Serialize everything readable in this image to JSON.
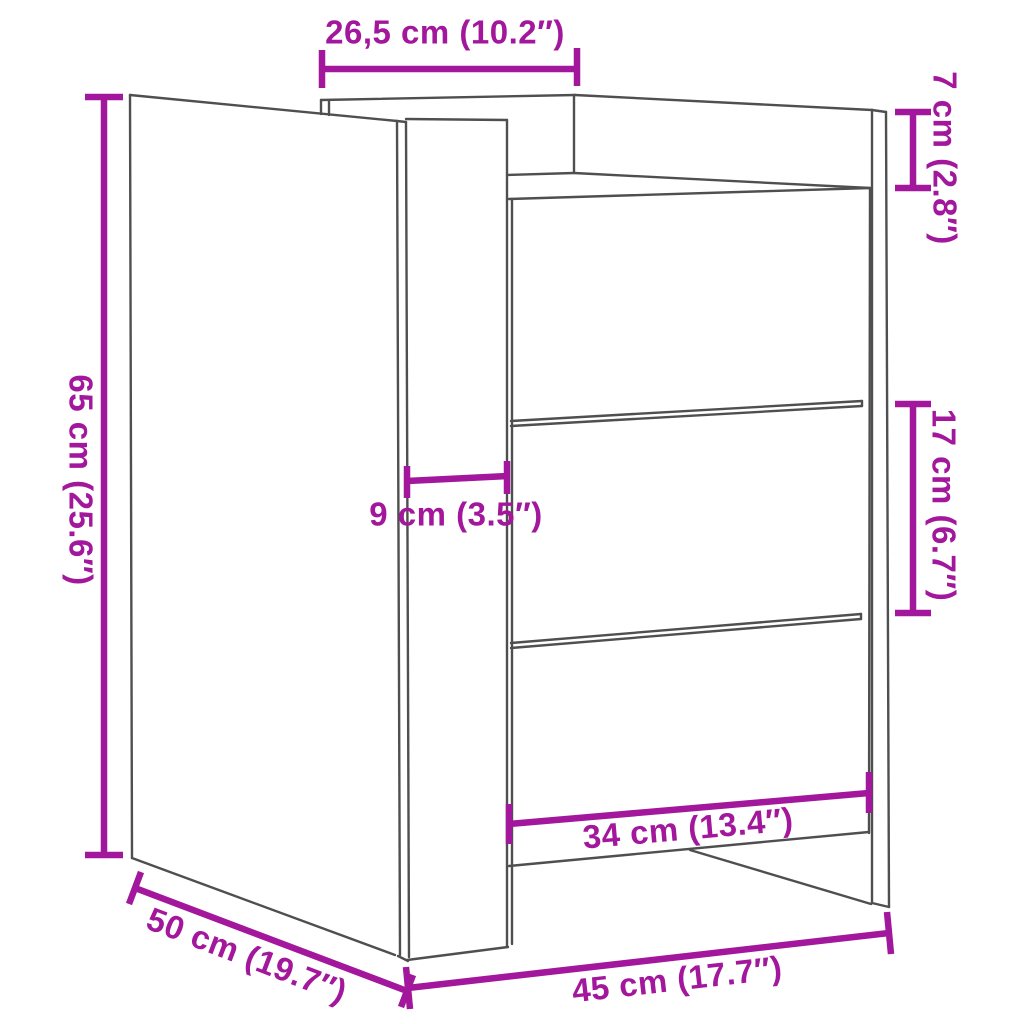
{
  "diagram": {
    "subject": "three-drawer-bedside-cabinet-line-drawing",
    "style": "isometric-product-dimension-diagram"
  },
  "colors": {
    "dimension": "#A2179B",
    "outline": "#4F4F4F",
    "background": "#FFFFFF"
  },
  "dimensions": {
    "top_width": {
      "label": "26,5 cm (10.2″)"
    },
    "top_height": {
      "label": "7 cm (2.8″)"
    },
    "height": {
      "label": "65 cm (25.6″)"
    },
    "side_offset": {
      "label": "9 cm (3.5″)"
    },
    "drawer_height": {
      "label": "17 cm (6.7″)"
    },
    "drawer_width": {
      "label": "34 cm (13.4″)"
    },
    "depth": {
      "label": "50 cm (19.7″)"
    },
    "width": {
      "label": "45 cm (17.7″)"
    }
  }
}
